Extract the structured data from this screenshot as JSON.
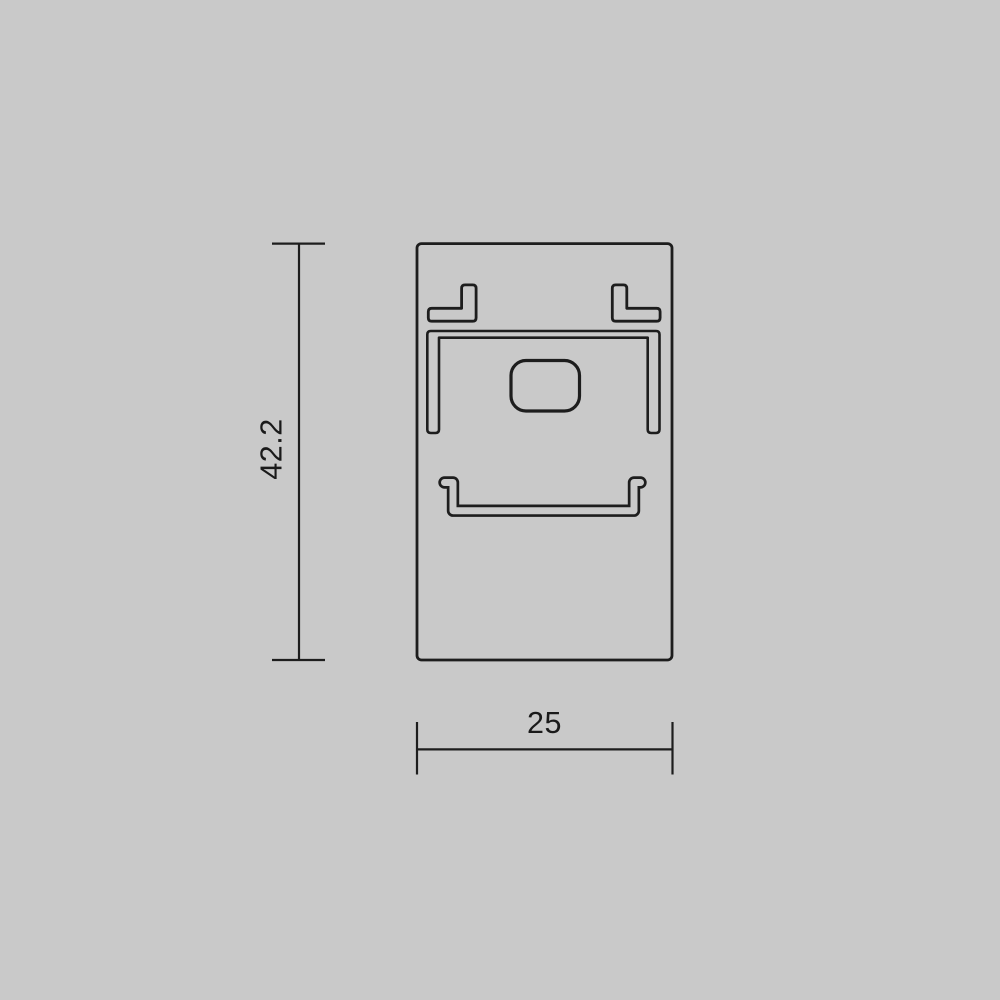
{
  "drawing": {
    "kind": "technical-dimension-drawing",
    "dimensions": {
      "height_label": "42.2",
      "width_label": "25"
    }
  },
  "theme": {
    "background": "#c9c9c9",
    "line": "#1d1d1d",
    "text": "#1a1a1a"
  }
}
